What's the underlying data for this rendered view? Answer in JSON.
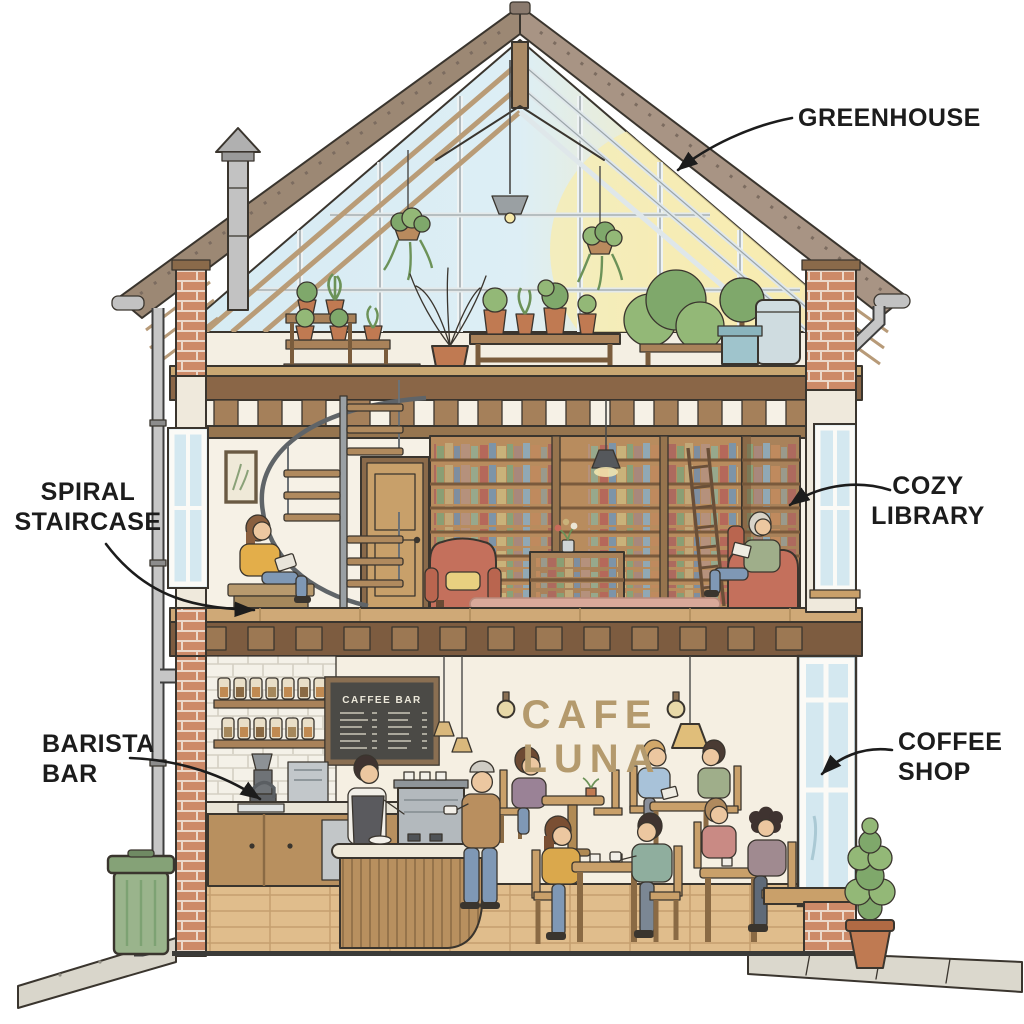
{
  "annotations": {
    "greenhouse": {
      "lines": [
        "GREENHOUSE"
      ]
    },
    "spiral_staircase": {
      "lines": [
        "SPIRAL",
        "STAIRCASE"
      ]
    },
    "cozy_library": {
      "lines": [
        "COZY",
        "LIBRARY"
      ]
    },
    "barista_bar": {
      "lines": [
        "BARISTA",
        "BAR"
      ]
    },
    "coffee_shop": {
      "lines": [
        "COFFEE",
        "SHOP"
      ]
    }
  },
  "signs": {
    "wall_sign": {
      "line1": "CAFE",
      "line2": "LUNA"
    },
    "menu_board": {
      "title": "CAFFEE BAR"
    }
  },
  "colors": {
    "label_ink": "#1c1c1c",
    "outline_ink": "#3a352e",
    "wall_sign_text": "#b49a6d",
    "brick": "#cd8a68",
    "wood": "#a9825a",
    "glass_sky": "#d6ebf3",
    "sun_glow": "#f6e6ae",
    "foliage": "#7fa86b",
    "menu_board_bg": "#4b4a46",
    "bin_green": "#9ab48c",
    "armchair_red": "#c4705c",
    "floor_wood": "#e0bd8c"
  }
}
